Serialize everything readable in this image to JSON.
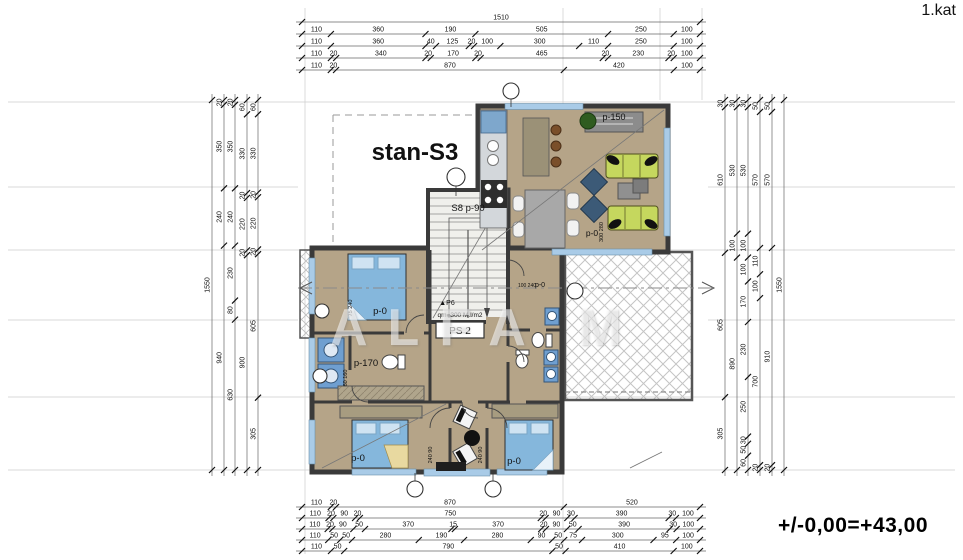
{
  "header": {
    "floor_label": "1.kat"
  },
  "footer": {
    "level_label": "+/-0,00=+43,00"
  },
  "watermark": "ALFA M",
  "plan": {
    "unit_label": "stan-S3",
    "room_labels": [
      {
        "name": "unit-label",
        "text": "stan-S3",
        "x": 415,
        "y": 160,
        "size": 24,
        "bold": true
      },
      {
        "text": "p-150",
        "x": 614,
        "y": 120,
        "size": 9
      },
      {
        "text": "S8 p-90",
        "x": 468,
        "y": 211,
        "size": 9.5
      },
      {
        "text": "p-0",
        "x": 380,
        "y": 314,
        "size": 9.5
      },
      {
        "text": "75 240",
        "x": 352,
        "y": 308,
        "size": 5.5,
        "rot": -90
      },
      {
        "text": "p-170",
        "x": 366,
        "y": 366,
        "size": 9.5
      },
      {
        "text": "60 160",
        "x": 347,
        "y": 378,
        "size": 5.5,
        "rot": -90
      },
      {
        "text": "qm=300 M.l/m2",
        "x": 460,
        "y": 317,
        "size": 6.5
      },
      {
        "text": "▲P6",
        "x": 447,
        "y": 305,
        "size": 7
      },
      {
        "text": "PS 2",
        "x": 460,
        "y": 334,
        "size": 10
      },
      {
        "text": "p-0",
        "x": 592,
        "y": 236,
        "size": 8.5
      },
      {
        "text": "300 280",
        "x": 603,
        "y": 232,
        "size": 5.5,
        "rot": -90
      },
      {
        "text": "p-0",
        "x": 540,
        "y": 287,
        "size": 7
      },
      {
        "text": "100 240",
        "x": 527,
        "y": 287,
        "size": 5
      },
      {
        "text": "p-0",
        "x": 358,
        "y": 461,
        "size": 9.5
      },
      {
        "text": "240 90",
        "x": 432,
        "y": 455,
        "size": 5.5,
        "rot": -90
      },
      {
        "text": "p-0",
        "x": 514,
        "y": 464,
        "size": 9.5
      },
      {
        "text": "240 90",
        "x": 482,
        "y": 455,
        "size": 5.5,
        "rot": -90
      }
    ]
  },
  "dimensions": {
    "top": {
      "rows": [
        [
          "1510"
        ],
        [
          "110",
          "360",
          "190",
          "505",
          "250",
          "100"
        ],
        [
          "110",
          "360",
          "40",
          "125",
          "20",
          "100",
          "300",
          "110",
          "250",
          "100"
        ],
        [
          "110",
          "20",
          "340",
          "20",
          "170",
          "20",
          "465",
          "20",
          "230",
          "20",
          "100"
        ],
        [
          "110",
          "20",
          "870",
          "420",
          "100"
        ]
      ]
    },
    "bottom": {
      "rows": [
        [
          "110",
          "20",
          "870",
          "520"
        ],
        [
          "110",
          "20",
          "90",
          "20",
          "750",
          "20",
          "90",
          "30",
          "390",
          "30",
          "100"
        ],
        [
          "110",
          "20",
          "90",
          "50",
          "370",
          "15",
          "370",
          "20",
          "90",
          "50",
          "390",
          "30",
          "100"
        ],
        [
          "110",
          "50",
          "50",
          "280",
          "190",
          "280",
          "90",
          "50",
          "75",
          "300",
          "95",
          "100"
        ],
        [
          "110",
          "50",
          "790",
          "50",
          "410",
          "100"
        ]
      ]
    },
    "left": {
      "cols": [
        [
          "1550"
        ],
        [
          "20",
          "350",
          "240",
          "940"
        ],
        [
          "20",
          "350",
          "240",
          "230",
          "80",
          "630"
        ],
        [
          "60",
          "330",
          "20",
          "220",
          "20",
          "900"
        ],
        [
          "60",
          "330",
          "20",
          "220",
          "20",
          "605",
          "305"
        ]
      ]
    },
    "right": {
      "cols": [
        [
          "30",
          "610",
          "605",
          "305"
        ],
        [
          "30",
          "530",
          "100",
          "890"
        ],
        [
          "30",
          "530",
          "100",
          "100",
          "170",
          "230",
          "250",
          "30",
          "50",
          "60"
        ],
        [
          "50",
          "570",
          "110",
          "100",
          "700",
          "20"
        ],
        [
          "50",
          "570",
          "910",
          "20"
        ],
        [
          "1550"
        ]
      ]
    }
  },
  "colors": {
    "floor": "#b5a488",
    "wall": "#3a3a3a",
    "stair_fill": "#f0f0ec",
    "sofa_green": "#c5d75e",
    "bed_blue": "#85b7dc",
    "armchair_navy": "#3c5a77",
    "appliance_blue": "#6f9fd0",
    "window_blue": "#a9cbe7",
    "hatch_gray": "#c4c4c4",
    "plant_green": "#2f5c20"
  }
}
